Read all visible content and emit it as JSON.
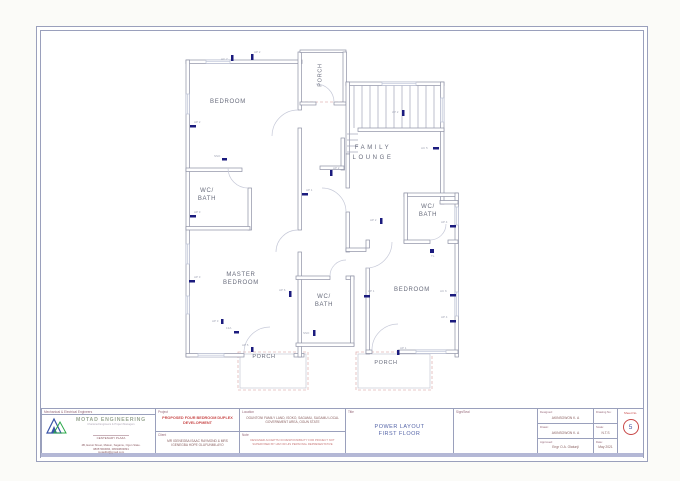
{
  "colors": {
    "line": "#9aa0bc",
    "wall": "#8d90a4",
    "accent_red": "#c84848",
    "accent_blue": "#5565a8",
    "socket_navy": "#1b1b7e",
    "porch_pink": "#e2b6b6"
  },
  "plan": {
    "rooms": {
      "bedroom1": {
        "line1": "BEDROOM"
      },
      "wc_left": {
        "line1": "WC/",
        "line2": "BATH"
      },
      "master": {
        "line1": "MASTER",
        "line2": "BEDROOM"
      },
      "lounge": {
        "line1": "FAMILY",
        "line2": "LOUNGE"
      },
      "wc_right": {
        "line1": "WC/",
        "line2": "BATH"
      },
      "bedroom2": {
        "line1": "BEDROOM"
      },
      "wc_center": {
        "line1": "WC/",
        "line2": "BATH"
      },
      "porch_top": {
        "line1": "PORCH"
      },
      "porch_bl": {
        "line1": "PORCH"
      },
      "porch_br": {
        "line1": "PORCH"
      }
    },
    "sockets": [
      {
        "x": 231,
        "y": 55,
        "w": 2.5,
        "h": 6,
        "label": "AC 7",
        "lx": 221,
        "ly": 60
      },
      {
        "x": 251,
        "y": 54,
        "w": 2.5,
        "h": 6,
        "label": "AP 2",
        "lx": 254,
        "ly": 53
      },
      {
        "x": 190,
        "y": 125,
        "w": 6,
        "h": 2.5,
        "label": "AP 2",
        "lx": 194,
        "ly": 123
      },
      {
        "x": 190,
        "y": 215,
        "w": 6,
        "h": 2.5,
        "label": "AP 3",
        "lx": 194,
        "ly": 213
      },
      {
        "x": 189,
        "y": 280,
        "w": 6,
        "h": 2.5,
        "label": "AP 3",
        "lx": 194,
        "ly": 278
      },
      {
        "x": 222,
        "y": 158,
        "w": 5,
        "h": 2.5,
        "label": "SSO",
        "lx": 214,
        "ly": 157
      },
      {
        "x": 221,
        "y": 319,
        "w": 2.5,
        "h": 5,
        "label": "AP 3",
        "lx": 212,
        "ly": 322
      },
      {
        "x": 302,
        "y": 193,
        "w": 6,
        "h": 2.5,
        "label": "AP 1",
        "lx": 306,
        "ly": 191
      },
      {
        "x": 402,
        "y": 110,
        "w": 2.5,
        "h": 6,
        "label": "AP 2",
        "lx": 392,
        "ly": 113
      },
      {
        "x": 433,
        "y": 147,
        "w": 6,
        "h": 2.5,
        "label": "AC 5",
        "lx": 421,
        "ly": 149
      },
      {
        "x": 330,
        "y": 170,
        "w": 2.5,
        "h": 6,
        "label": "AP 2",
        "lx": 333,
        "ly": 169
      },
      {
        "x": 380,
        "y": 218,
        "w": 2.5,
        "h": 6,
        "label": "AP 2",
        "lx": 370,
        "ly": 221
      },
      {
        "x": 450,
        "y": 225,
        "w": 6,
        "h": 2.5,
        "label": "AP 4",
        "lx": 441,
        "ly": 223
      },
      {
        "x": 430,
        "y": 249,
        "w": 4,
        "h": 4,
        "label": "TL",
        "lx": 431,
        "ly": 257
      },
      {
        "x": 450,
        "y": 294,
        "w": 6,
        "h": 2.5,
        "label": "AC 6",
        "lx": 440,
        "ly": 292
      },
      {
        "x": 450,
        "y": 320,
        "w": 6,
        "h": 2.5,
        "label": "AP 4",
        "lx": 441,
        "ly": 318
      },
      {
        "x": 289,
        "y": 291,
        "w": 2.5,
        "h": 6,
        "label": "AP 6",
        "lx": 279,
        "ly": 291
      },
      {
        "x": 313,
        "y": 330,
        "w": 2.5,
        "h": 6,
        "label": "SSO",
        "lx": 303,
        "ly": 334
      },
      {
        "x": 234,
        "y": 331,
        "w": 5,
        "h": 2.5,
        "label": "13A",
        "lx": 226,
        "ly": 329
      },
      {
        "x": 364,
        "y": 295,
        "w": 6,
        "h": 2.5,
        "label": "AP 1",
        "lx": 368,
        "ly": 292
      },
      {
        "x": 251,
        "y": 347,
        "w": 2.5,
        "h": 5,
        "label": "AP 5",
        "lx": 242,
        "ly": 346
      },
      {
        "x": 397,
        "y": 350,
        "w": 2.5,
        "h": 5,
        "label": "AP 1",
        "lx": 400,
        "ly": 349
      }
    ]
  },
  "titleblock": {
    "engineers_strip": "Mechanical & Electrical Engineers",
    "company": {
      "name": "MOTAD ENGINEERING",
      "tagline": "Chartered Engineers & Project Managers",
      "plaza": "CENTENARY PLAZA",
      "address": "4B, Ewusi Street, Makun, Sagamu, Ogun State.",
      "phones": "08057903084, 08033803891",
      "email": "motadltd@gmail.com"
    },
    "project": {
      "header": "Project",
      "value": "PROPOSED FOUR BEDROOM DUPLEX DEVELOPMENT"
    },
    "client": {
      "header": "Client",
      "value": "MR IGENEGBA ISAAC RAYMOND & MRS IGENEGBA HOPE OLUFUNMILAYO"
    },
    "location": {
      "header": "Location",
      "value": "OGUNTONI FAMILY LAND, ISOKO, SAGAMU, SAGAMU LOCAL GOVERNMENT AREA, OGUN STATE"
    },
    "note": {
      "header": "Note",
      "value": "DESIGNER ACCEPTS NO RESPONSIBILITY FOR PROJECT NOT SUPERVISED BY HIM OR HIS PERSONAL REPRESENTATIVE"
    },
    "title": {
      "header": "Title",
      "line1": "POWER LAYOUT",
      "line2": "FIRST FLOOR"
    },
    "sign": {
      "header": "Sign/Seal"
    },
    "people": [
      {
        "label": "Designed:",
        "value": "AKINSOWON K. A"
      },
      {
        "label": "Drawn:",
        "value": "AKINSOWON K. A"
      },
      {
        "label": "Approved:",
        "value": "Engr O.A. Olatunji"
      }
    ],
    "meta": [
      {
        "label": "Drawing No:",
        "value": ""
      },
      {
        "label": "Scale:",
        "value": "N.T.S"
      },
      {
        "label": "Date:",
        "value": "May 2021"
      }
    ],
    "sheet": {
      "label": "Sheet No.",
      "value": "5"
    }
  }
}
